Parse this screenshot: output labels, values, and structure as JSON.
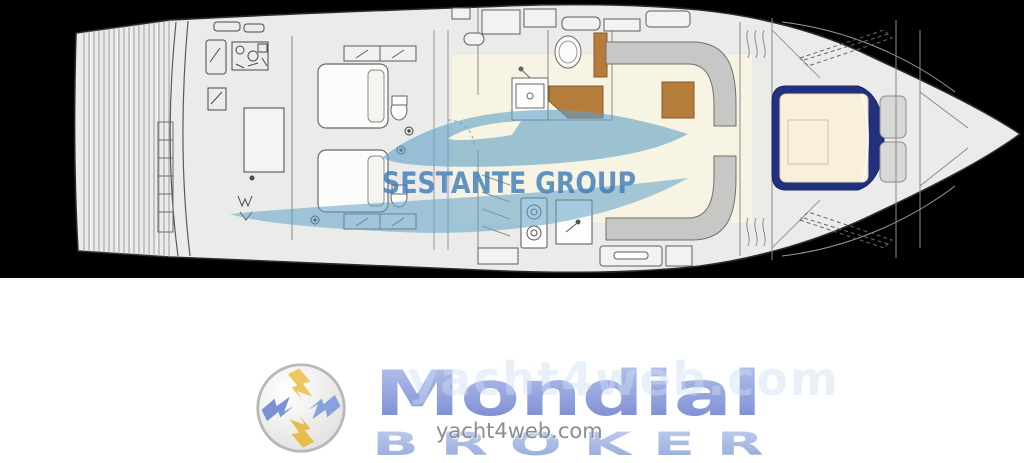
{
  "brand_watermark": {
    "text": "SESTANTE GROUP"
  },
  "site_watermark": {
    "text": "yacht4web.com",
    "ghost_text": "yacht4web.com"
  },
  "logo": {
    "title": "Mondial",
    "subtitle": "B R O K E R",
    "emblem_icon": "pinwheel-lightning-emblem"
  },
  "colors": {
    "band_background": "#000000",
    "hull_fill": "#ebebe9",
    "wood": "#b67c3c",
    "bed_frame_navy": "#22307e",
    "mattress_cream": "#f8f0da",
    "watermark_boat_blue": "#5fa0c6",
    "watermark_text_blue": "#3c7ab8",
    "logo_blue": "#8093d3",
    "logo_light_blue": "#a6b7e0",
    "emblem_yellow": "#eec75e",
    "site_text_gray": "#8d8d8d"
  }
}
